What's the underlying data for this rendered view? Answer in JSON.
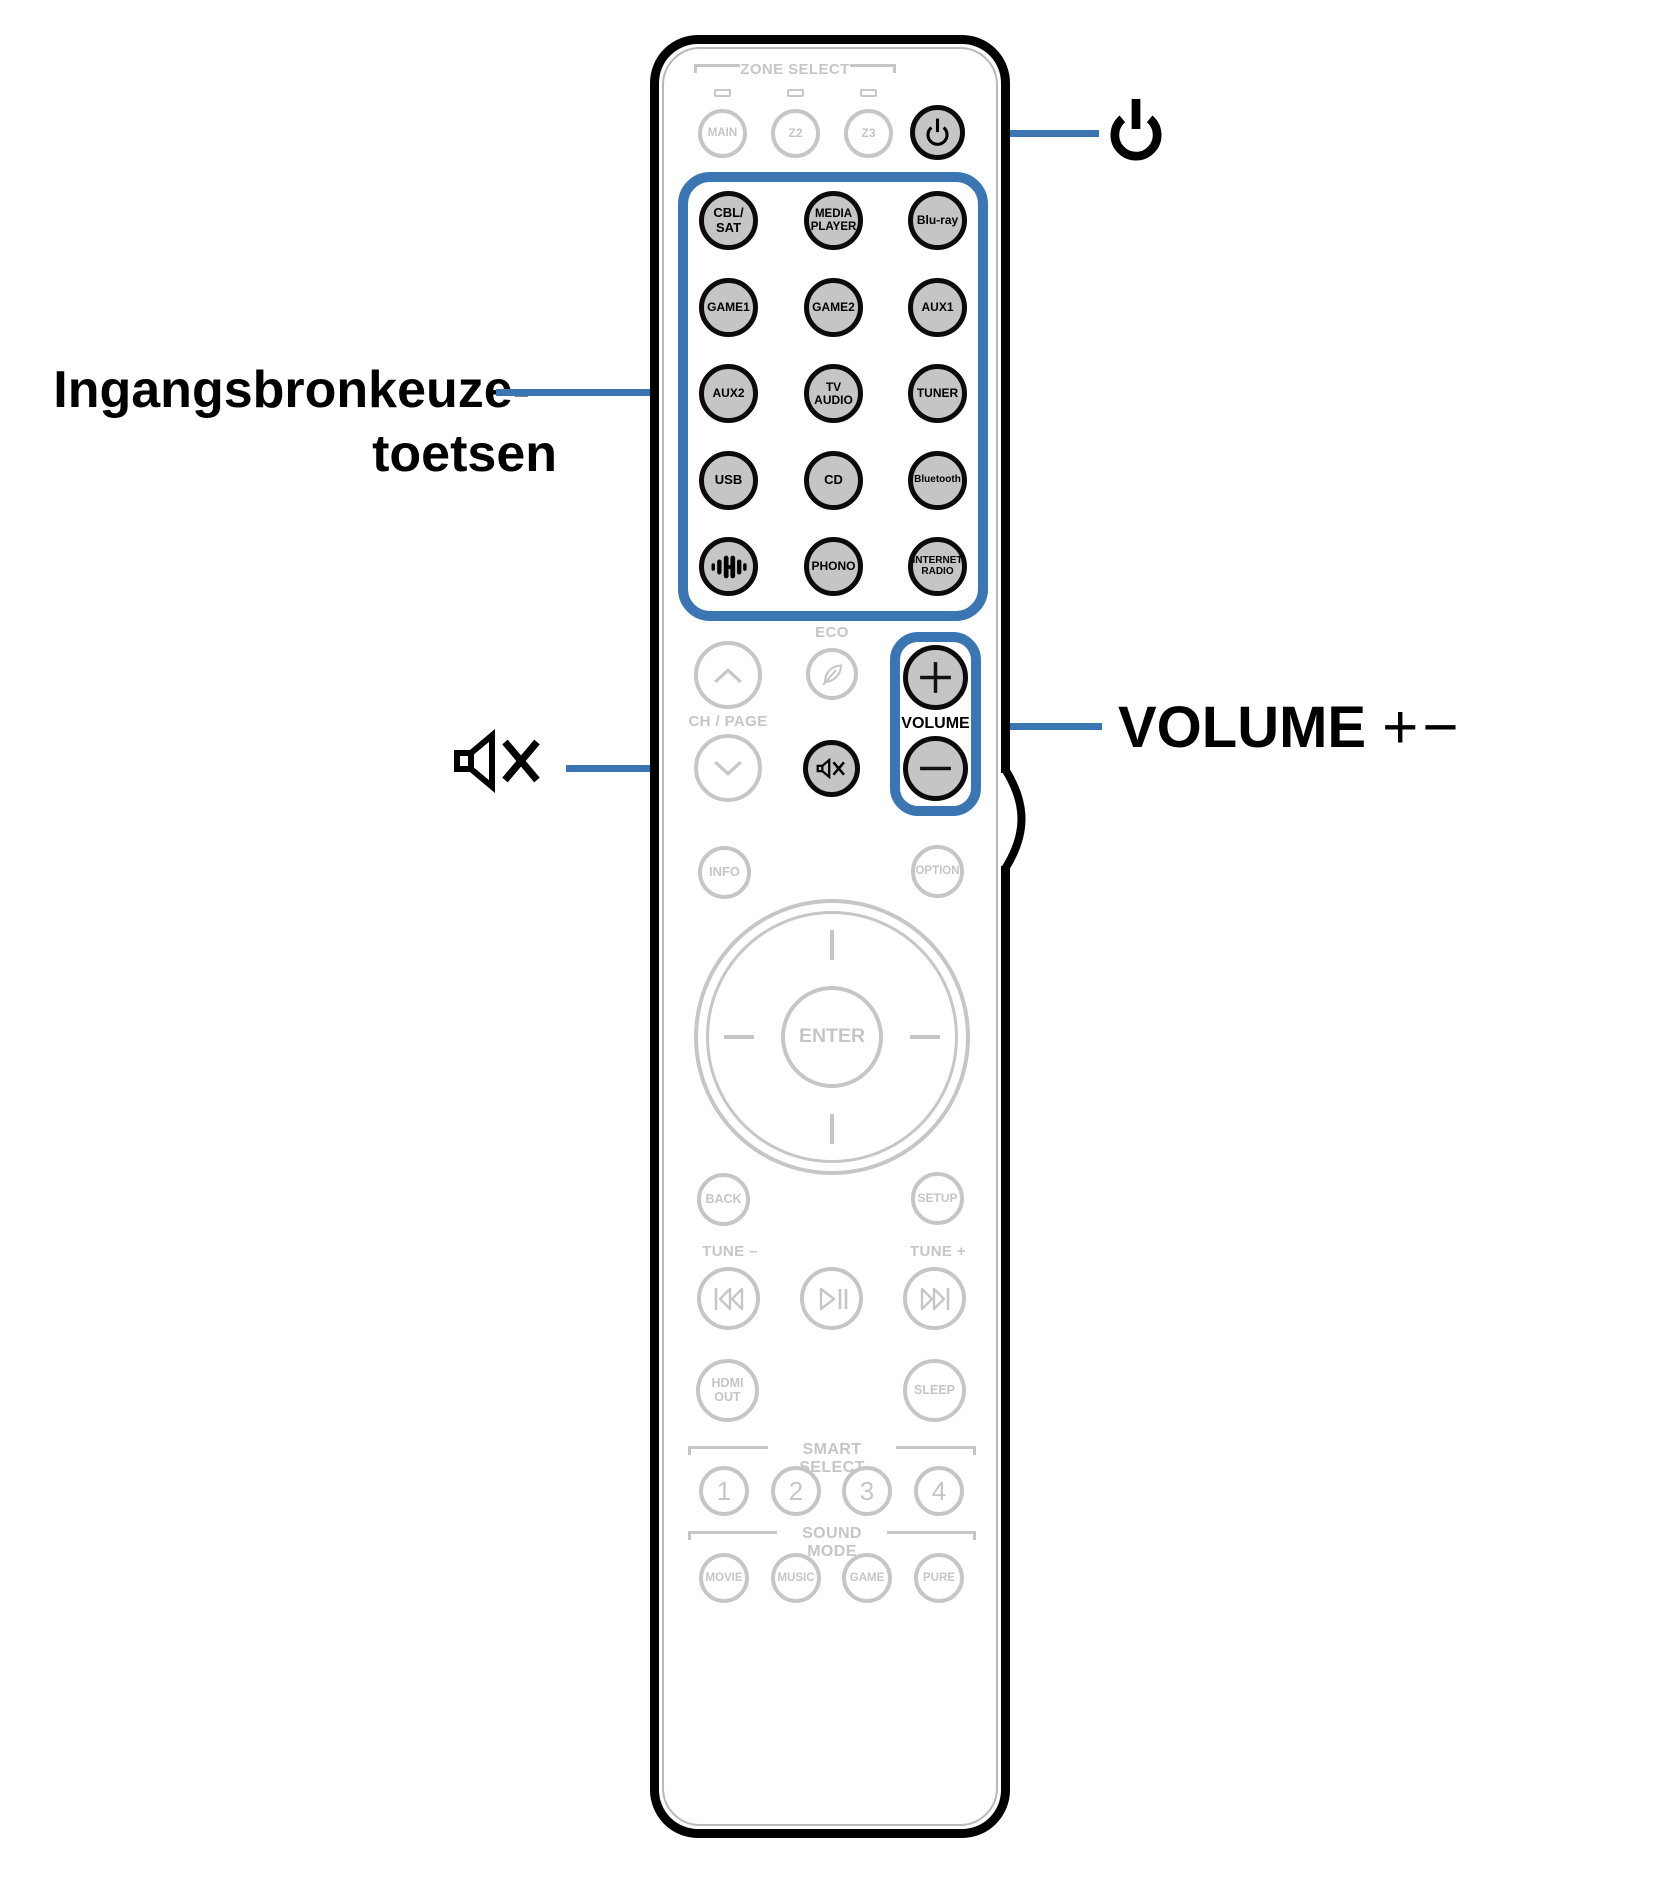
{
  "labels": {
    "input_sources_line1": "Ingangsbronkeuze-",
    "input_sources_line2": "toetsen",
    "volume_annotation": "VOLUME",
    "volume_annotation_suffix": "+−"
  },
  "remote": {
    "zone_header": "ZONE SELECT",
    "zone_buttons": [
      "MAIN",
      "Z2",
      "Z3"
    ],
    "inputs": [
      "CBL/\nSAT",
      "MEDIA\nPLAYER",
      "Blu-ray",
      "GAME1",
      "GAME2",
      "AUX1",
      "AUX2",
      "TV\nAUDIO",
      "TUNER",
      "USB",
      "CD",
      "Bluetooth",
      "PHONO",
      "INTERNET\nRADIO"
    ],
    "eco": "ECO",
    "ch_page": "CH / PAGE",
    "volume": "VOLUME",
    "info": "INFO",
    "option": "OPTION",
    "enter": "ENTER",
    "back": "BACK",
    "setup": "SETUP",
    "tune_minus": "TUNE –",
    "tune_plus": "TUNE +",
    "hdmi_out": "HDMI\nOUT",
    "sleep": "SLEEP",
    "smart_select_header": "SMART SELECT",
    "smart_select_buttons": [
      "1",
      "2",
      "3",
      "4"
    ],
    "sound_mode_header": "SOUND MODE",
    "sound_mode_buttons": [
      "MOVIE",
      "MUSIC",
      "GAME",
      "PURE"
    ]
  },
  "colors": {
    "accent_blue": "#3c76b2",
    "button_fill_gray": "#c5c5c5",
    "inactive_gray": "#c6c6c6"
  }
}
